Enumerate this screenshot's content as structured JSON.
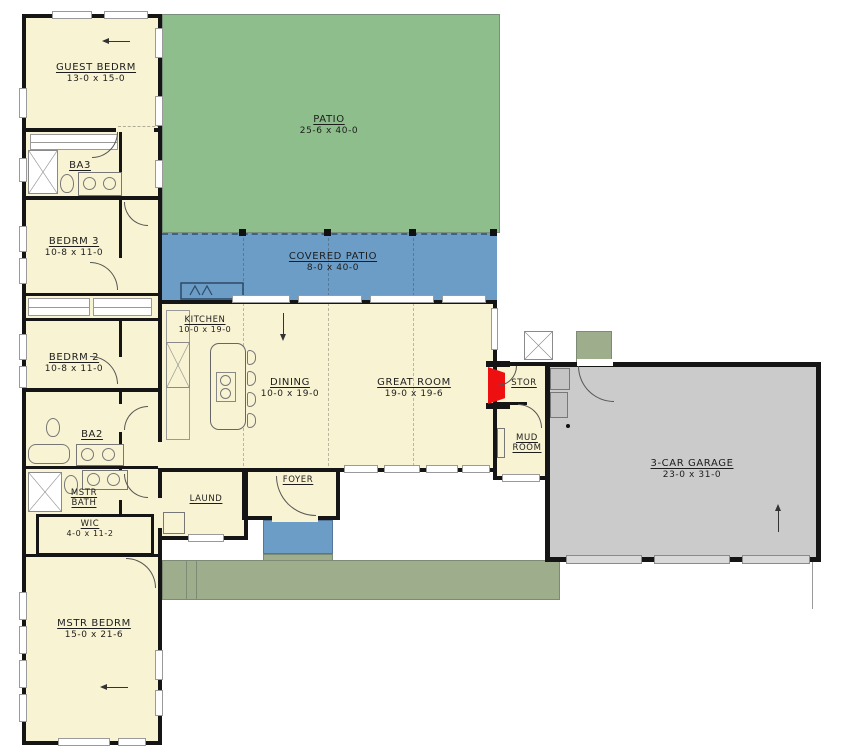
{
  "plan": {
    "title": "single-story house floor plan",
    "rooms": {
      "guest_bedrm": {
        "name": "GUEST BEDRM",
        "dims": "13-0 x 15-0"
      },
      "ba3": {
        "name": "BA3"
      },
      "bedrm3": {
        "name": "BEDRM 3",
        "dims": "10-8 x 11-0"
      },
      "bedrm2": {
        "name": "BEDRM 2",
        "dims": "10-8 x 11-0"
      },
      "ba2": {
        "name": "BA2"
      },
      "mstr_bath": {
        "name": "MSTR BATH"
      },
      "wic": {
        "name": "WIC",
        "dims": "4-0 x 11-2"
      },
      "mstr_bedrm": {
        "name": "MSTR BEDRM",
        "dims": "15-0 x 21-6"
      },
      "patio": {
        "name": "PATIO",
        "dims": "25-6 x 40-0"
      },
      "covered_patio": {
        "name": "COVERED PATIO",
        "dims": "8-0 x 40-0"
      },
      "kitchen": {
        "name": "KITCHEN",
        "dims": "10-0 x 19-0"
      },
      "dining": {
        "name": "DINING",
        "dims": "10-0 x 19-0"
      },
      "great_room": {
        "name": "GREAT ROOM",
        "dims": "19-0 x 19-6"
      },
      "stor": {
        "name": "STOR"
      },
      "mud_room": {
        "name": "MUD ROOM"
      },
      "laund": {
        "name": "LAUND"
      },
      "foyer": {
        "name": "FOYER"
      },
      "garage": {
        "name": "3-CAR GARAGE",
        "dims": "23-0 x 31-0"
      }
    },
    "colors": {
      "floor": "#f8f3d2",
      "patio": "#8ebe8b",
      "covered": "#6b9dc7",
      "garage": "#cbcbcb",
      "walkway": "#9ead8c",
      "red": "#ee1010",
      "wall": "#151515"
    }
  }
}
